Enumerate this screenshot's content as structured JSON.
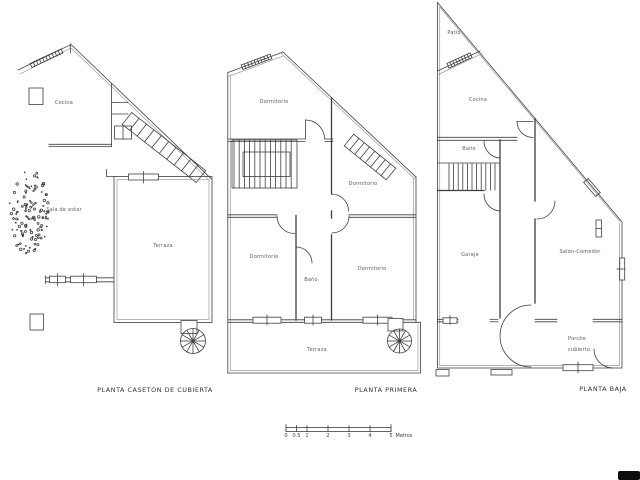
{
  "colors": {
    "line": "#3f3f3f",
    "blue_square": "#1d3c63",
    "gray_square": "#858585",
    "stair_landing": "#b0b0b0",
    "label_text": "#5a5a66",
    "caption_text": "#36322d"
  },
  "plans": {
    "caseton": {
      "caption": "PLANTA CASETON DE CUBIERTA",
      "rooms": {
        "cocina": "Cocina",
        "sala_de_estar": "Sala de estar",
        "terraza": "Terraza"
      }
    },
    "primera": {
      "caption": "PLANTA PRIMERA",
      "rooms": {
        "dormitorio_top": "Dormitorio",
        "dormitorio_right_upper": "Dormitorio",
        "dormitorio_left": "Dormitorio",
        "bano": "Baño",
        "dormitorio_right_lower": "Dormitorio",
        "terraza": "Terraza"
      }
    },
    "baja": {
      "caption": "PLANTA BAJA",
      "rooms": {
        "patio": "Patio",
        "cocina": "Cocina",
        "bano": "Baño",
        "garaje": "Garaje",
        "salon_comedor": "Salón-Comedor",
        "porche_line1": "Porche",
        "porche_line2": "cubierto"
      }
    }
  },
  "scale_bar": {
    "tick_labels": [
      "0",
      "0.5",
      "1",
      "2",
      "3",
      "4",
      "5"
    ],
    "unit": "Metros"
  }
}
